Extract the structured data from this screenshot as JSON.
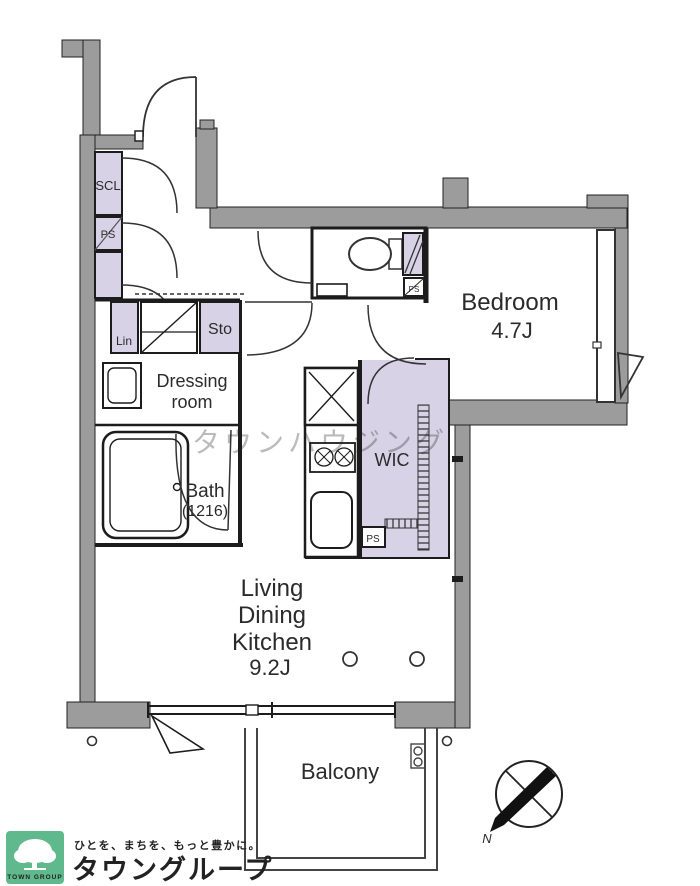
{
  "floorplan": {
    "labels": {
      "scl": "SCL",
      "ps": "PS",
      "lin": "Lin",
      "sto": "Sto",
      "dressing_line1": "Dressing",
      "dressing_line2": "room",
      "bath": "Bath",
      "bath_size": "(1216)",
      "wic": "WIC",
      "bedroom": "Bedroom",
      "bedroom_size": "4.7J",
      "ldk_line1": "Living",
      "ldk_line2": "Dining",
      "ldk_line3": "Kitchen",
      "ldk_size": "9.2J",
      "balcony": "Balcony"
    },
    "compass": {
      "north": "N"
    },
    "watermark": "タウンハウジング",
    "colors": {
      "wall": "#9c9c9c",
      "closet": "#d7d2e6"
    }
  },
  "footer": {
    "logo_square_text": "TOWN GROUP",
    "tagline": "ひとを、まちを、もっと豊かに。",
    "brand": "タウングループ",
    "brand_color": "#5fb98c"
  }
}
